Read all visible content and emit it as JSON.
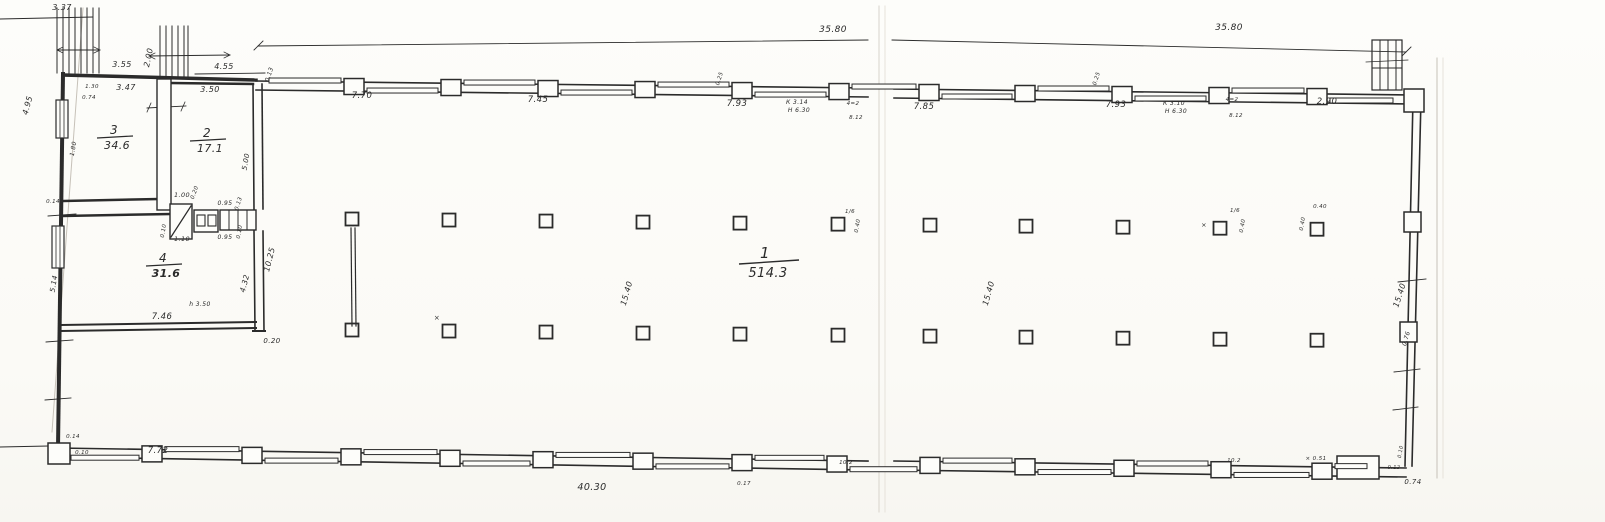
{
  "sheet": {
    "colors": {
      "paper": "#fdfdfa",
      "ink": "#2b2b2b",
      "faint": "#c6c1b8",
      "faint2": "#d8d4cc",
      "faint3": "#e6e2da"
    }
  },
  "rooms": [
    {
      "number": "3",
      "area": "34.6",
      "cx": 114,
      "cy": 134,
      "big": false,
      "areaBold": false
    },
    {
      "number": "2",
      "area": "17.1",
      "cx": 207,
      "cy": 137,
      "big": false,
      "areaBold": false
    },
    {
      "number": "4",
      "area": "31.6",
      "cx": 163,
      "cy": 262,
      "big": false,
      "areaBold": true
    },
    {
      "number": "1",
      "area": "514.3",
      "cx": 765,
      "cy": 258,
      "big": true,
      "areaBold": false
    }
  ],
  "labels": [
    {
      "t": "3.37",
      "x": 62,
      "y": 10,
      "s": 8
    },
    {
      "t": "3.55",
      "x": 122,
      "y": 67,
      "s": 8
    },
    {
      "t": "2.00",
      "x": 151,
      "y": 58,
      "s": 8,
      "r": -78
    },
    {
      "t": "4.55",
      "x": 224,
      "y": 69,
      "s": 8
    },
    {
      "t": "0.13",
      "x": 271,
      "y": 75,
      "s": 6,
      "r": -72
    },
    {
      "t": "1.30",
      "x": 92,
      "y": 88,
      "s": 5.5
    },
    {
      "t": "0.74",
      "x": 89,
      "y": 99,
      "s": 5.5
    },
    {
      "t": "3.47",
      "x": 126,
      "y": 90,
      "s": 8
    },
    {
      "t": "3.50",
      "x": 210,
      "y": 92,
      "s": 8
    },
    {
      "t": "4.95",
      "x": 30,
      "y": 106,
      "s": 8,
      "r": -75
    },
    {
      "t": "5.00",
      "x": 248,
      "y": 162,
      "s": 7,
      "r": -80
    },
    {
      "t": "1.80",
      "x": 75,
      "y": 149,
      "s": 6,
      "r": -80
    },
    {
      "t": "7.70",
      "x": 362,
      "y": 98,
      "s": 8.5
    },
    {
      "t": "7.45",
      "x": 538,
      "y": 102,
      "s": 8.5
    },
    {
      "t": "7.93",
      "x": 737,
      "y": 106,
      "s": 8.5
    },
    {
      "t": "К 3.14",
      "x": 797,
      "y": 104,
      "s": 6
    },
    {
      "t": "Н 6.30",
      "x": 799,
      "y": 112,
      "s": 6
    },
    {
      "t": "0.25",
      "x": 721,
      "y": 79,
      "s": 5.5,
      "r": -72
    },
    {
      "t": "4=2",
      "x": 853,
      "y": 105,
      "s": 5.5
    },
    {
      "t": "8.12",
      "x": 856,
      "y": 119,
      "s": 5.5
    },
    {
      "t": "35.80",
      "x": 833,
      "y": 32,
      "s": 9
    },
    {
      "t": "35.80",
      "x": 1229,
      "y": 30,
      "s": 9
    },
    {
      "t": "7.85",
      "x": 924,
      "y": 109,
      "s": 8.5
    },
    {
      "t": "7.93",
      "x": 1116,
      "y": 107,
      "s": 8.5
    },
    {
      "t": "К 3.10",
      "x": 1174,
      "y": 105,
      "s": 6
    },
    {
      "t": "Н 6.30",
      "x": 1176,
      "y": 113,
      "s": 6
    },
    {
      "t": "0.25",
      "x": 1098,
      "y": 79,
      "s": 5.5,
      "r": -72
    },
    {
      "t": "4=2",
      "x": 1232,
      "y": 101,
      "s": 5.5
    },
    {
      "t": "8.12",
      "x": 1236,
      "y": 117,
      "s": 5.5
    },
    {
      "t": "2.90",
      "x": 1327,
      "y": 104,
      "s": 8.5
    },
    {
      "t": "1.00",
      "x": 182,
      "y": 197,
      "s": 6.5
    },
    {
      "t": "0.20",
      "x": 196,
      "y": 193,
      "s": 5.5,
      "r": -70
    },
    {
      "t": "0.95",
      "x": 225,
      "y": 205,
      "s": 6
    },
    {
      "t": "0.95",
      "x": 225,
      "y": 239,
      "s": 6
    },
    {
      "t": "1.10",
      "x": 182,
      "y": 241,
      "s": 6.5
    },
    {
      "t": "0.10",
      "x": 165,
      "y": 231,
      "s": 5.5,
      "r": -80
    },
    {
      "t": "0.13",
      "x": 240,
      "y": 204,
      "s": 5.5,
      "r": -72
    },
    {
      "t": "0.10",
      "x": 241,
      "y": 232,
      "s": 5.5,
      "r": -80
    },
    {
      "t": "10.25",
      "x": 272,
      "y": 260,
      "s": 8,
      "r": -76
    },
    {
      "t": "4.32",
      "x": 247,
      "y": 284,
      "s": 7.5,
      "r": -76
    },
    {
      "t": "0.20",
      "x": 272,
      "y": 343,
      "s": 7
    },
    {
      "t": "h 3.50",
      "x": 200,
      "y": 306,
      "s": 6
    },
    {
      "t": "7.46",
      "x": 162,
      "y": 319,
      "s": 8.5
    },
    {
      "t": "5.14",
      "x": 56,
      "y": 284,
      "s": 7,
      "r": -80
    },
    {
      "t": "0.14",
      "x": 53,
      "y": 203,
      "s": 5.5
    },
    {
      "t": "15.40",
      "x": 629,
      "y": 294,
      "s": 8,
      "r": -74
    },
    {
      "t": "15.40",
      "x": 991,
      "y": 294,
      "s": 8,
      "r": -74
    },
    {
      "t": "15.40",
      "x": 1402,
      "y": 296,
      "s": 8,
      "r": -72
    },
    {
      "t": "0.76",
      "x": 1408,
      "y": 339,
      "s": 6,
      "r": -74
    },
    {
      "t": "×",
      "x": 437,
      "y": 320,
      "s": 7
    },
    {
      "t": "1/6",
      "x": 850,
      "y": 213,
      "s": 5.5
    },
    {
      "t": "0.40",
      "x": 859,
      "y": 226,
      "s": 5.5,
      "r": -80
    },
    {
      "t": "×",
      "x": 1204,
      "y": 227,
      "s": 6.5
    },
    {
      "t": "1/6",
      "x": 1235,
      "y": 212,
      "s": 5.5
    },
    {
      "t": "0.40",
      "x": 1244,
      "y": 226,
      "s": 5.5,
      "r": -80
    },
    {
      "t": "0.40",
      "x": 1320,
      "y": 208,
      "s": 5.5
    },
    {
      "t": "0.40",
      "x": 1304,
      "y": 224,
      "s": 5.5,
      "r": -80
    },
    {
      "t": "7.72",
      "x": 158,
      "y": 453,
      "s": 8.5
    },
    {
      "t": "0.14",
      "x": 73,
      "y": 438,
      "s": 5.5
    },
    {
      "t": "0.10",
      "x": 82,
      "y": 454,
      "s": 5.5
    },
    {
      "t": "40.30",
      "x": 592,
      "y": 490,
      "s": 9.5
    },
    {
      "t": "0.17",
      "x": 744,
      "y": 485,
      "s": 5.5
    },
    {
      "t": "10.2",
      "x": 846,
      "y": 464,
      "s": 5.5
    },
    {
      "t": "10.2",
      "x": 1234,
      "y": 462,
      "s": 5.5
    },
    {
      "t": "× 0.51",
      "x": 1316,
      "y": 460,
      "s": 5.5
    },
    {
      "t": "0.74",
      "x": 1413,
      "y": 484,
      "s": 7
    },
    {
      "t": "0.10",
      "x": 1402,
      "y": 452,
      "s": 5,
      "r": -80
    },
    {
      "t": "0.12",
      "x": 1394,
      "y": 469,
      "s": 5
    }
  ],
  "geometry": {
    "lines": [
      [
        83,
        8,
        52,
        432,
        1,
        "faint"
      ],
      [
        879,
        6,
        879,
        512,
        1,
        "faint2"
      ],
      [
        885,
        6,
        885,
        512,
        1,
        "faint3"
      ],
      [
        1437,
        58,
        1437,
        478,
        1,
        "faint"
      ],
      [
        1443,
        58,
        1443,
        478,
        1,
        "faint3"
      ],
      [
        0,
        19,
        93,
        17,
        1
      ],
      [
        258,
        46,
        868,
        40,
        0.9
      ],
      [
        892,
        40,
        1406,
        52,
        0.9
      ],
      [
        254,
        50,
        263,
        41,
        0.9
      ],
      [
        1402,
        56,
        1411,
        47,
        0.9
      ],
      [
        195,
        74,
        265,
        73,
        0.9
      ],
      [
        147,
        108,
        186,
        106,
        0.9
      ],
      [
        151,
        103,
        147,
        112,
        0.8
      ],
      [
        185,
        102,
        181,
        111,
        0.8
      ],
      [
        63,
        74,
        58,
        448,
        4
      ],
      [
        63,
        75,
        256,
        80,
        3.5
      ],
      [
        64,
        201,
        158,
        199,
        2.5
      ],
      [
        171,
        83,
        253,
        84,
        2.5
      ],
      [
        253,
        84,
        254,
        209,
        1.6
      ],
      [
        262,
        84,
        263,
        209,
        1.6
      ],
      [
        254,
        231,
        255,
        331,
        1.6
      ],
      [
        263,
        231,
        264,
        331,
        1.6
      ],
      [
        63,
        216,
        170,
        214,
        2.5
      ],
      [
        61,
        325,
        256,
        322,
        2
      ],
      [
        61,
        331,
        256,
        328,
        2
      ],
      [
        253,
        331,
        265,
        331,
        2
      ],
      [
        256,
        81,
        868,
        88,
        1.6
      ],
      [
        894,
        89,
        1412,
        95,
        1.6
      ],
      [
        256,
        90,
        868,
        97,
        1.6
      ],
      [
        894,
        98,
        1412,
        104,
        1.6
      ],
      [
        1413,
        99,
        1405,
        466,
        1.6
      ],
      [
        1421,
        99,
        1412,
        466,
        1.6
      ],
      [
        1398,
        282,
        1426,
        279,
        0.9
      ],
      [
        1394,
        372,
        1420,
        369,
        0.9
      ],
      [
        1393,
        410,
        1418,
        407,
        0.9
      ],
      [
        58,
        448,
        868,
        461,
        1.6
      ],
      [
        894,
        461,
        1406,
        468,
        1.6
      ],
      [
        58,
        457,
        868,
        470,
        1.6
      ],
      [
        894,
        470,
        1406,
        477,
        1.6
      ],
      [
        48,
        216,
        76,
        214,
        0.9
      ],
      [
        46,
        342,
        73,
        340,
        0.9
      ],
      [
        45,
        400,
        71,
        398,
        0.9
      ],
      [
        0,
        447,
        48,
        446,
        1
      ],
      [
        57,
        8,
        57,
        73,
        1
      ],
      [
        63,
        8,
        63,
        73,
        1
      ],
      [
        69,
        8,
        69,
        73,
        1
      ],
      [
        75,
        8,
        75,
        73,
        1
      ],
      [
        81,
        8,
        81,
        73,
        1
      ],
      [
        87,
        8,
        87,
        73,
        1
      ],
      [
        93,
        8,
        93,
        73,
        1
      ],
      [
        99,
        8,
        99,
        73,
        1
      ],
      [
        57,
        50,
        100,
        50,
        0.9
      ],
      [
        57,
        50,
        63,
        47,
        0.8
      ],
      [
        57,
        50,
        63,
        53,
        0.8
      ],
      [
        100,
        50,
        94,
        47,
        0.8
      ],
      [
        100,
        50,
        94,
        53,
        0.8
      ],
      [
        160,
        26,
        160,
        77,
        1
      ],
      [
        166,
        26,
        166,
        77,
        1
      ],
      [
        172,
        26,
        172,
        77,
        1
      ],
      [
        178,
        26,
        178,
        77,
        1
      ],
      [
        184,
        26,
        184,
        77,
        1
      ],
      [
        188,
        26,
        188,
        77,
        1
      ],
      [
        149,
        56,
        230,
        55,
        0.9
      ],
      [
        230,
        55,
        224,
        52,
        0.8
      ],
      [
        230,
        55,
        224,
        58,
        0.8
      ],
      [
        149,
        56,
        155,
        53,
        0.8
      ],
      [
        149,
        56,
        155,
        59,
        0.8
      ],
      [
        351,
        228,
        352,
        326,
        1.2
      ],
      [
        355,
        228,
        356,
        326,
        1.2
      ]
    ],
    "rects": [
      [
        157,
        79,
        14,
        131,
        1.4,
        1
      ],
      [
        170,
        204,
        22,
        35,
        1.4,
        1
      ],
      [
        194,
        210,
        24,
        22,
        1.4,
        1
      ],
      [
        197,
        215,
        8,
        11,
        1.1,
        0
      ],
      [
        208,
        215,
        8,
        11,
        1.1,
        0
      ],
      [
        220,
        210,
        36,
        20,
        1.4,
        1
      ],
      [
        1372,
        40,
        30,
        50,
        1.2,
        0
      ],
      [
        56,
        100,
        12,
        38,
        1.2,
        1
      ],
      [
        52,
        226,
        12,
        42,
        1.2,
        1
      ],
      [
        1404,
        89,
        20,
        23,
        1.5,
        1
      ],
      [
        1404,
        212,
        17,
        20,
        1.5,
        1
      ],
      [
        1400,
        322,
        17,
        20,
        1.5,
        1
      ],
      [
        1337,
        456,
        42,
        23,
        1.5,
        1
      ],
      [
        48,
        443,
        22,
        21,
        1.5,
        1
      ]
    ],
    "lines2": [
      [
        171,
        237,
        191,
        206,
        1.3
      ],
      [
        229,
        211,
        229,
        229,
        1
      ],
      [
        238,
        211,
        238,
        229,
        1
      ],
      [
        247,
        211,
        247,
        229,
        1
      ],
      [
        60,
        101,
        60,
        137,
        0.8
      ],
      [
        64,
        101,
        64,
        137,
        0.8
      ],
      [
        56,
        227,
        56,
        267,
        0.8
      ],
      [
        60,
        227,
        60,
        267,
        0.8
      ],
      [
        1380,
        40,
        1380,
        90,
        1
      ],
      [
        1388,
        40,
        1388,
        90,
        1
      ],
      [
        1396,
        40,
        1396,
        90,
        1
      ],
      [
        1372,
        68,
        1402,
        68,
        1
      ],
      [
        1366,
        62,
        1408,
        60,
        0.8
      ],
      [
        1372,
        56,
        1372,
        66,
        0.8
      ],
      [
        1402,
        55,
        1402,
        64,
        0.8
      ]
    ],
    "top_piers": {
      "xs": [
        354,
        451,
        548,
        645,
        742,
        839,
        929,
        1025,
        1122,
        1219,
        1317
      ],
      "x0": 256,
      "y0": 85.5,
      "slope": 0.0104,
      "w": 20,
      "h": 16
    },
    "bottom_piers": {
      "xs": [
        152,
        252,
        351,
        450,
        543,
        643,
        742,
        837,
        930,
        1025,
        1124,
        1221,
        1322
      ],
      "x0": 58,
      "y0": 452.5,
      "slope": 0.0148,
      "w": 20,
      "h": 16
    },
    "top_windows": {
      "edges": [
        256,
        354,
        451,
        548,
        645,
        742,
        839,
        929,
        1025,
        1122,
        1219,
        1317,
        1406
      ],
      "x0": 256,
      "y0": 85.5,
      "slope": 0.0104,
      "offEven": -8,
      "offOdd": 1
    },
    "bottom_windows": {
      "edges": [
        58,
        152,
        252,
        351,
        450,
        543,
        643,
        742,
        837,
        930,
        1025,
        1124,
        1221,
        1322,
        1380
      ],
      "x0": 58,
      "y0": 452.5,
      "slope": 0.0148,
      "offEven": 2,
      "offOdd": -8
    },
    "columns": {
      "xs": [
        352,
        449,
        546,
        643,
        740,
        838,
        930,
        1026,
        1123,
        1220,
        1317
      ],
      "x0": 352,
      "topY0": 219,
      "botY0": 330,
      "slope": 0.0106,
      "size": 13
    }
  }
}
